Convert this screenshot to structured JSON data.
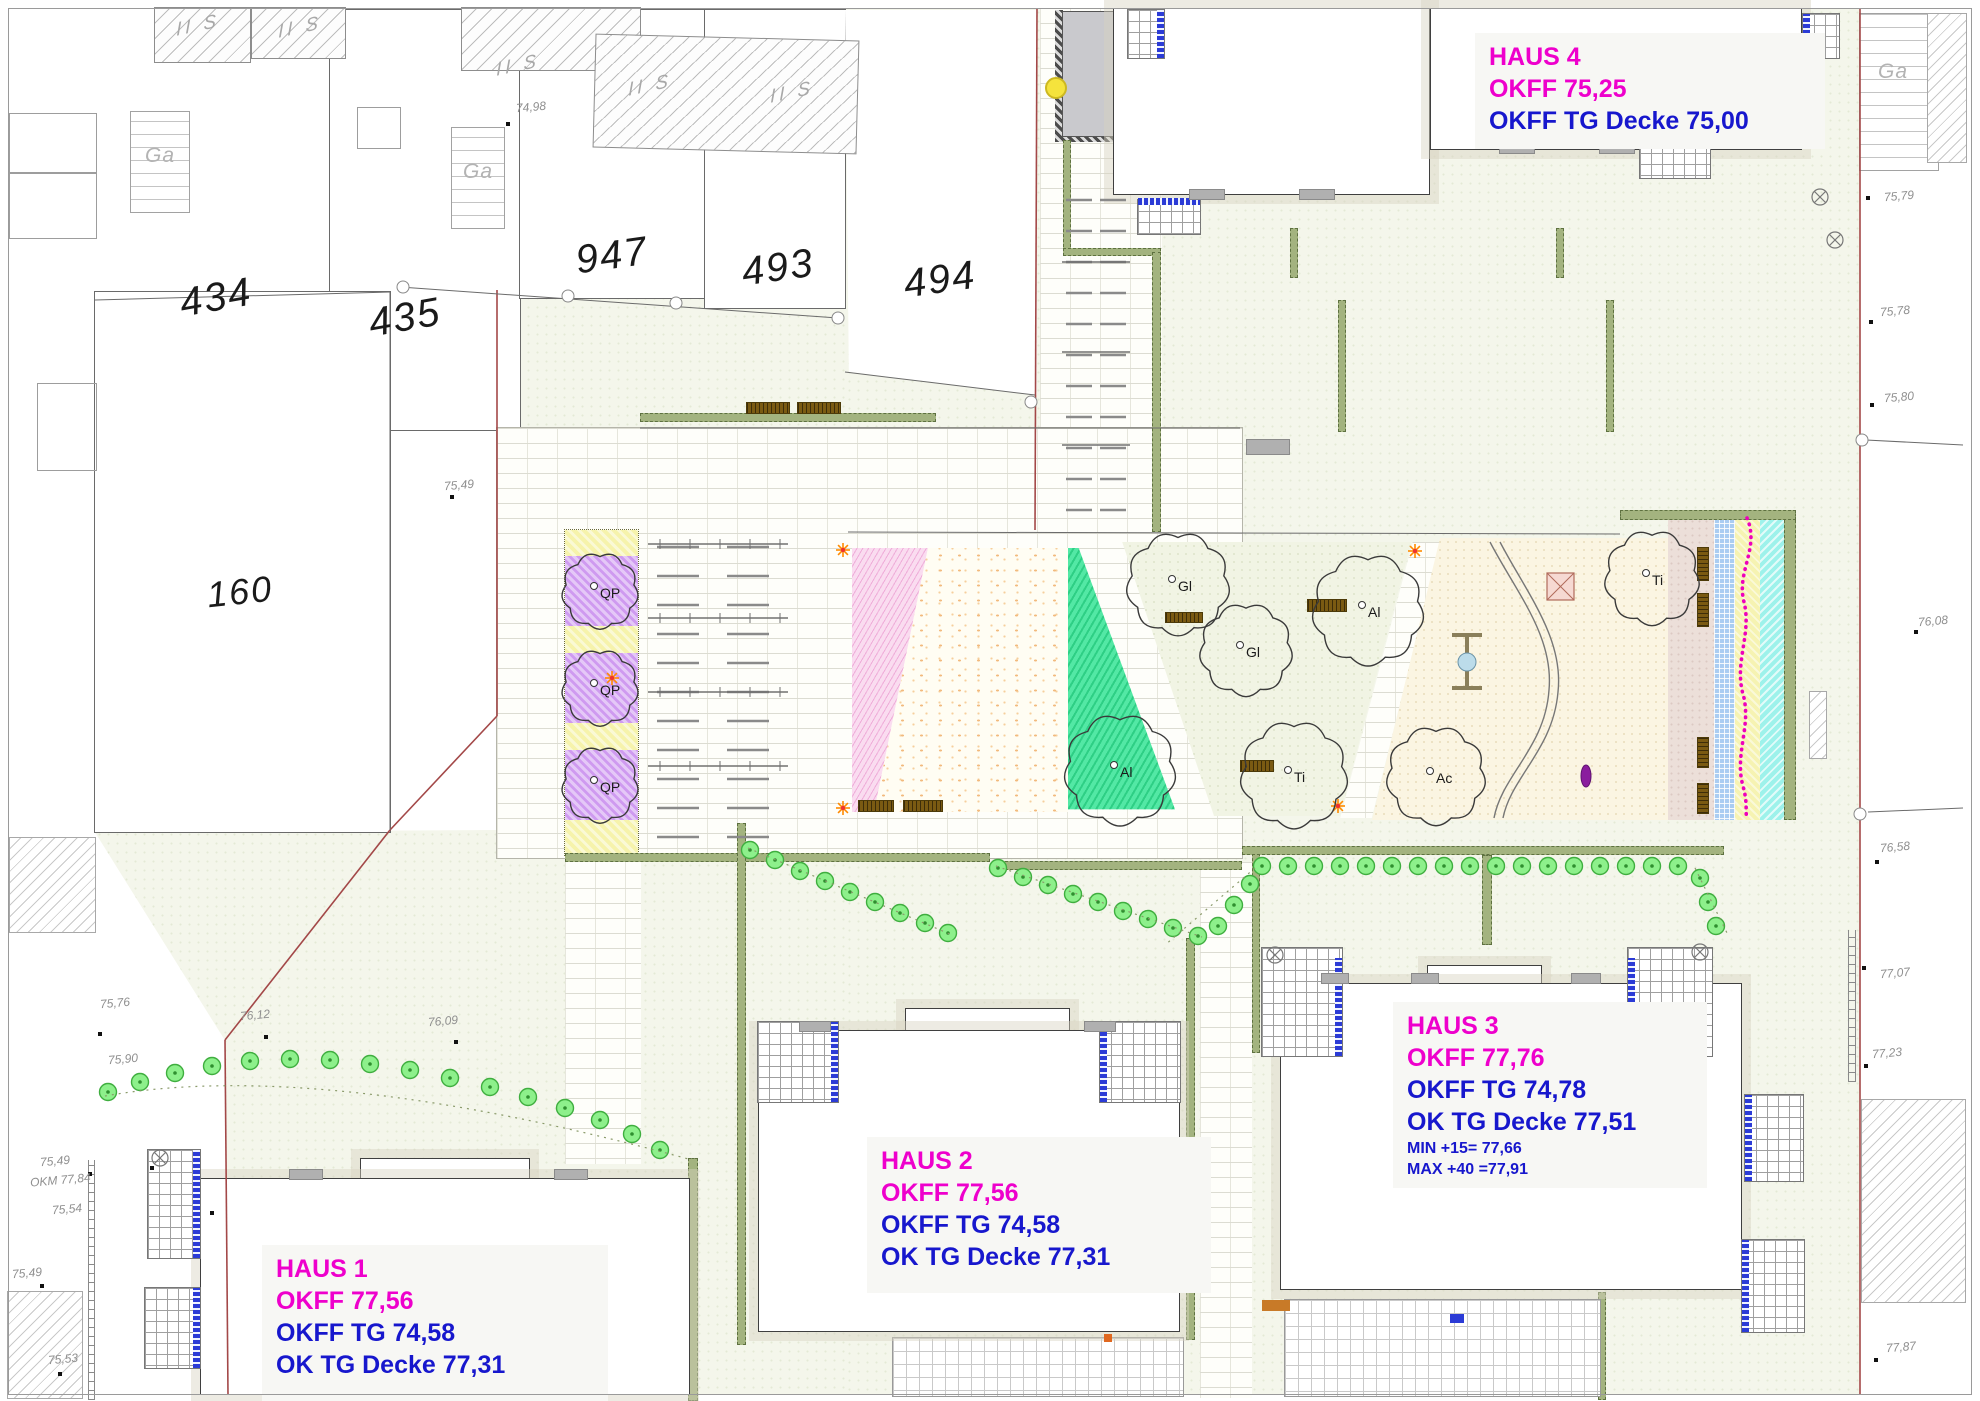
{
  "title": "Lageplan HAUS 1-4",
  "colors": {
    "magenta": "#ee00cc",
    "blue": "#1717cd",
    "hedge_green": "#a3b37f",
    "bush_green": "#8df08b",
    "bench_brown": "#7a5a12",
    "boundary_red": "#a34848",
    "strip_blue": "#aacdf2",
    "strip_yellow": "#f6f3b2",
    "strip_cyan": "#9df2eb",
    "qp_purple": "#cf9af0",
    "play_green": "#2ecf85",
    "play_pink": "#efadd9"
  },
  "houses": [
    {
      "name": "HAUS 1",
      "x": 262,
      "y": 1245,
      "w": 318,
      "h": 140,
      "rows": [
        {
          "text": "HAUS 1",
          "color": "magenta",
          "size": "lg"
        },
        {
          "text": "OKFF 77,56",
          "color": "magenta",
          "size": "lg"
        },
        {
          "text": "OKFF TG 74,58",
          "color": "blue",
          "size": "lg"
        },
        {
          "text": "OK TG Decke 77,31",
          "color": "blue",
          "size": "lg"
        }
      ]
    },
    {
      "name": "HAUS 2",
      "x": 867,
      "y": 1137,
      "w": 316,
      "h": 140,
      "rows": [
        {
          "text": "HAUS 2",
          "color": "magenta",
          "size": "lg"
        },
        {
          "text": "OKFF 77,56",
          "color": "magenta",
          "size": "lg"
        },
        {
          "text": "OKFF TG 74,58",
          "color": "blue",
          "size": "lg"
        },
        {
          "text": "OK TG Decke 77,31",
          "color": "blue",
          "size": "lg"
        }
      ]
    },
    {
      "name": "HAUS 3",
      "x": 1393,
      "y": 1002,
      "w": 286,
      "h": 168,
      "rows": [
        {
          "text": "HAUS 3",
          "color": "magenta",
          "size": "lg"
        },
        {
          "text": "OKFF 77,76",
          "color": "magenta",
          "size": "lg"
        },
        {
          "text": "OKFF TG 74,78",
          "color": "blue",
          "size": "lg"
        },
        {
          "text": "OK TG Decke 77,51",
          "color": "blue",
          "size": "lg"
        },
        {
          "text": "MIN +15= 77,66",
          "color": "blue",
          "size": "sm"
        },
        {
          "text": "MAX +40 =77,91",
          "color": "blue",
          "size": "sm"
        }
      ]
    },
    {
      "name": "HAUS 4",
      "x": 1475,
      "y": 33,
      "w": 322,
      "h": 100,
      "rows": [
        {
          "text": "HAUS 4",
          "color": "magenta",
          "size": "lg"
        },
        {
          "text": "OKFF 75,25",
          "color": "magenta",
          "size": "lg"
        },
        {
          "text": "OKFF TG Decke 75,00",
          "color": "blue",
          "size": "lg"
        }
      ]
    }
  ],
  "parcels": [
    {
      "label": "434",
      "x": 216,
      "y": 298,
      "rot": -10,
      "size": 40
    },
    {
      "label": "435",
      "x": 405,
      "y": 318,
      "rot": -10,
      "size": 40
    },
    {
      "label": "947",
      "x": 612,
      "y": 256,
      "rot": -8,
      "size": 40
    },
    {
      "label": "493",
      "x": 778,
      "y": 268,
      "rot": -8,
      "size": 40
    },
    {
      "label": "494",
      "x": 940,
      "y": 280,
      "rot": -8,
      "size": 40
    },
    {
      "label": "160",
      "x": 240,
      "y": 592,
      "rot": -6,
      "size": 36
    }
  ],
  "garages": [
    {
      "label": "Ga",
      "x": 160,
      "y": 156
    },
    {
      "label": "Ga",
      "x": 478,
      "y": 172
    },
    {
      "label": "Ga",
      "x": 1893,
      "y": 72
    }
  ],
  "storey_marks": [
    {
      "label": "II S",
      "x": 198,
      "y": 26
    },
    {
      "label": "II S",
      "x": 300,
      "y": 28
    },
    {
      "label": "II S",
      "x": 518,
      "y": 66
    },
    {
      "label": "II S",
      "x": 650,
      "y": 86
    },
    {
      "label": "II S",
      "x": 792,
      "y": 93
    }
  ],
  "spot_elevations": [
    {
      "label": "74,98",
      "x": 516,
      "y": 100,
      "dot": [
        508,
        124
      ]
    },
    {
      "label": "75,49",
      "x": 444,
      "y": 478,
      "dot": [
        452,
        497
      ]
    },
    {
      "label": "75,76",
      "x": 100,
      "y": 996,
      "dot": [
        100,
        1034
      ]
    },
    {
      "label": "76,12",
      "x": 240,
      "y": 1008,
      "dot": [
        266,
        1037
      ]
    },
    {
      "label": "76,09",
      "x": 428,
      "y": 1014,
      "dot": [
        456,
        1042
      ]
    },
    {
      "label": "75,90",
      "x": 108,
      "y": 1052,
      "dot": null
    },
    {
      "label": "75,49",
      "x": 40,
      "y": 1154,
      "dot": [
        90,
        1174
      ]
    },
    {
      "label": "OKM 77,84",
      "x": 30,
      "y": 1173,
      "dot": [
        152,
        1168
      ]
    },
    {
      "label": "75,54",
      "x": 52,
      "y": 1202,
      "dot": [
        212,
        1213
      ]
    },
    {
      "label": "75,49",
      "x": 12,
      "y": 1266,
      "dot": [
        42,
        1286
      ]
    },
    {
      "label": "75,53",
      "x": 48,
      "y": 1352,
      "dot": [
        60,
        1374
      ]
    },
    {
      "label": "75,79",
      "x": 1884,
      "y": 189,
      "dot": [
        1868,
        198
      ]
    },
    {
      "label": "75,78",
      "x": 1880,
      "y": 304,
      "dot": [
        1871,
        322
      ]
    },
    {
      "label": "75,80",
      "x": 1884,
      "y": 390,
      "dot": [
        1872,
        405
      ]
    },
    {
      "label": "76,08",
      "x": 1918,
      "y": 614,
      "dot": [
        1916,
        632
      ]
    },
    {
      "label": "76,58",
      "x": 1880,
      "y": 840,
      "dot": [
        1877,
        862
      ]
    },
    {
      "label": "77,07",
      "x": 1880,
      "y": 966,
      "dot": [
        1864,
        968
      ]
    },
    {
      "label": "77,23",
      "x": 1872,
      "y": 1046,
      "dot": [
        1866,
        1066
      ]
    },
    {
      "label": "77,87",
      "x": 1886,
      "y": 1340,
      "dot": [
        1876,
        1360
      ]
    }
  ],
  "trees": [
    {
      "species": "QP",
      "x": 600,
      "y": 591,
      "r": 37
    },
    {
      "species": "QP",
      "x": 600,
      "y": 688,
      "r": 37
    },
    {
      "species": "QP",
      "x": 600,
      "y": 785,
      "r": 37
    },
    {
      "species": "Gl",
      "x": 1178,
      "y": 584,
      "r": 50
    },
    {
      "species": "Gl",
      "x": 1246,
      "y": 650,
      "r": 45
    },
    {
      "species": "Al",
      "x": 1368,
      "y": 610,
      "r": 54
    },
    {
      "species": "Ti",
      "x": 1294,
      "y": 775,
      "r": 52
    },
    {
      "species": "Ac",
      "x": 1436,
      "y": 776,
      "r": 48
    },
    {
      "species": "Al",
      "x": 1120,
      "y": 770,
      "r": 54
    },
    {
      "species": "Ti",
      "x": 1652,
      "y": 578,
      "r": 46
    }
  ]
}
